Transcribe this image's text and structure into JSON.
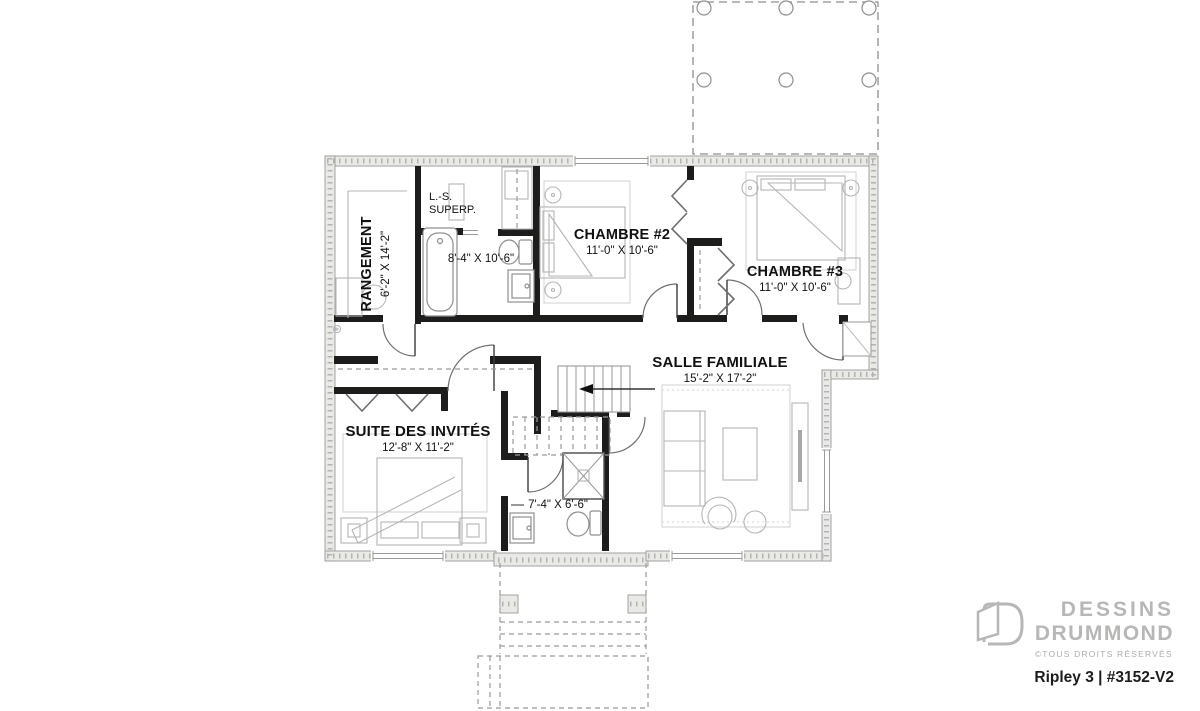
{
  "rooms": {
    "rangement": {
      "name": "RANGEMENT",
      "dims": "6'-2\" X 14'-2\""
    },
    "laundry": {
      "line1": "L.-S.",
      "line2": "SUPERP."
    },
    "bath1": {
      "dims": "8'-4\" X 10'-6\""
    },
    "chambre2": {
      "name": "CHAMBRE #2",
      "dims": "11'-0\" X 10'-6\""
    },
    "chambre3": {
      "name": "CHAMBRE #3",
      "dims": "11'-0\" X 10'-6\""
    },
    "salle_familiale": {
      "name": "SALLE FAMILIALE",
      "dims": "15'-2\" X 17'-2\""
    },
    "suite_invites": {
      "name": "SUITE DES INVITÉS",
      "dims": "12'-8\" X 11'-2\""
    },
    "bath2": {
      "dims": "7'-4\" X 6'-6\""
    }
  },
  "logo": {
    "brand_line1": "DESSINS",
    "brand_line2": "DRUMMOND",
    "copyright": "©TOUS DROITS RÉSERVÉS",
    "plan_name": "Ripley 3 | #3152-V2"
  },
  "icons": {
    "logo_door": "open-door-outline",
    "stair_arrow": "left-direction-arrow"
  },
  "colors": {
    "wall": "#1d1d1b",
    "foundation_fill": "#e9e9e6",
    "foundation_edge": "#9a9a9a",
    "furniture_line": "#b5b5b5",
    "logo_gray": "#b7b7b5",
    "text": "#111111"
  }
}
